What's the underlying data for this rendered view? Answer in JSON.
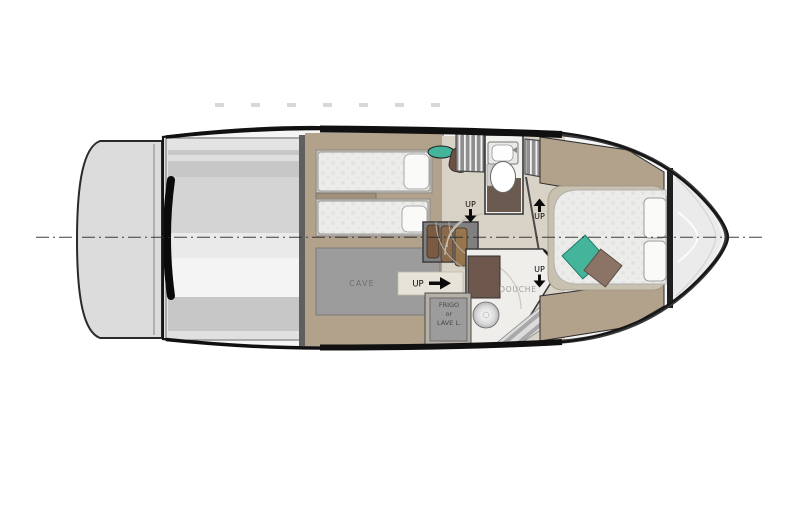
{
  "plan": {
    "name": "yacht-lower-deck-floor-plan",
    "labels": {
      "cave": "CAVE",
      "douche": "DOUCHE",
      "frigo_line1": "FRIGO",
      "frigo_line2": "or",
      "frigo_line3": "LAVE L.",
      "up": "UP"
    },
    "icons": {
      "up_aft_arrow": "right-arrow",
      "corridor_port_arrow": "down-arrow",
      "corridor_starboard_arrow": "up-arrow",
      "douche_arrow": "down-arrow"
    },
    "colors": {
      "hull_outline": "#151515",
      "swim_platform": "#dcdcdc",
      "deck_band_gray": "#c7c7c7",
      "wood_floor": "#b2a18b",
      "corridor_floor": "#d8d3c6",
      "cave_gray": "#9c9c9c",
      "mattress": "#ececea",
      "bathroom_floor": "#6b5a50",
      "vanity_brown": "#6e584e",
      "teal_cushion": "#44b59b",
      "brown_cushion": "#8b7366",
      "stair_wood": "#8a6a4c"
    }
  }
}
